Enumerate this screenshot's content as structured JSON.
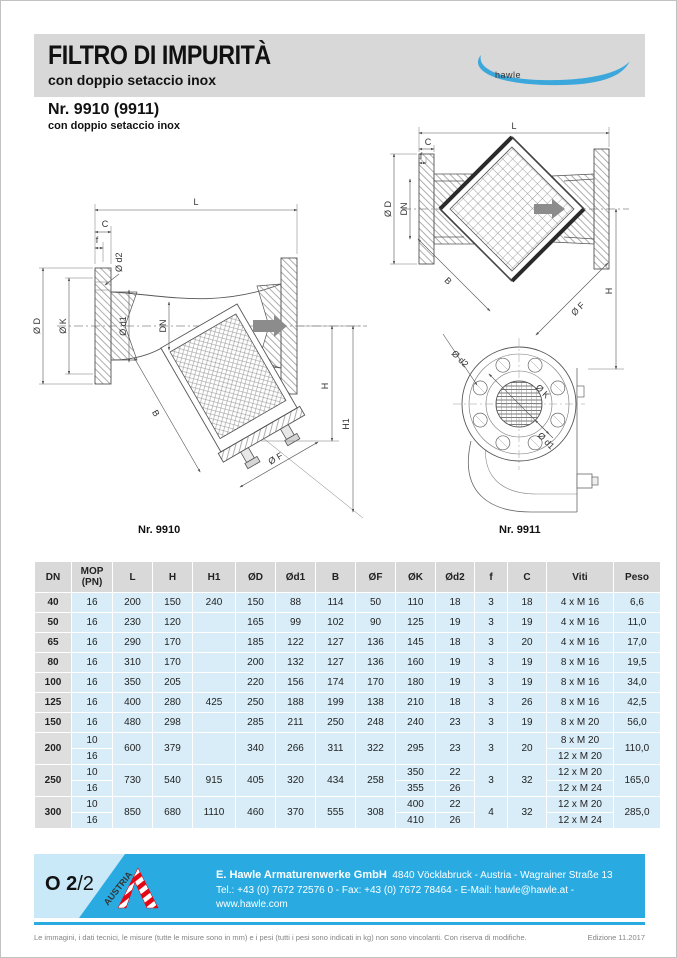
{
  "header": {
    "title": "FILTRO DI IMPURITÀ",
    "subtitle": "con doppio setaccio inox",
    "brand": "hawle"
  },
  "product": {
    "number": "Nr. 9910 (9911)",
    "variant": "con doppio setaccio inox"
  },
  "drawings": {
    "caption_9910": "Nr. 9910",
    "caption_9911": "Nr. 9911",
    "dim_labels": {
      "L": "L",
      "C": "C",
      "f": "f",
      "d2": "Ø d2",
      "D": "Ø D",
      "K": "Ø K",
      "d1": "Ø d1",
      "DN": "DN",
      "B": "B",
      "F": "Ø F",
      "H": "H",
      "H1": "H1"
    }
  },
  "table": {
    "headers": [
      "DN",
      "MOP (PN)",
      "L",
      "H",
      "H1",
      "ØD",
      "Ød1",
      "B",
      "ØF",
      "ØK",
      "Ød2",
      "f",
      "C",
      "Viti",
      "Peso"
    ],
    "rows": [
      {
        "dn": "40",
        "mop": [
          "16"
        ],
        "l": "200",
        "h": "150",
        "h1": "240",
        "D": "150",
        "d1": "88",
        "B": "114",
        "F": "50",
        "K": [
          "110"
        ],
        "d2": [
          "18"
        ],
        "f": "3",
        "c": "18",
        "viti": [
          "4 x M 16"
        ],
        "peso": "6,6"
      },
      {
        "dn": "50",
        "mop": [
          "16"
        ],
        "l": "230",
        "h": "120",
        "h1": "",
        "D": "165",
        "d1": "99",
        "B": "102",
        "F": "90",
        "K": [
          "125"
        ],
        "d2": [
          "19"
        ],
        "f": "3",
        "c": "19",
        "viti": [
          "4 x M 16"
        ],
        "peso": "11,0"
      },
      {
        "dn": "65",
        "mop": [
          "16"
        ],
        "l": "290",
        "h": "170",
        "h1": "",
        "D": "185",
        "d1": "122",
        "B": "127",
        "F": "136",
        "K": [
          "145"
        ],
        "d2": [
          "18"
        ],
        "f": "3",
        "c": "20",
        "viti": [
          "4 x M 16"
        ],
        "peso": "17,0"
      },
      {
        "dn": "80",
        "mop": [
          "16"
        ],
        "l": "310",
        "h": "170",
        "h1": "",
        "D": "200",
        "d1": "132",
        "B": "127",
        "F": "136",
        "K": [
          "160"
        ],
        "d2": [
          "19"
        ],
        "f": "3",
        "c": "19",
        "viti": [
          "8 x M 16"
        ],
        "peso": "19,5"
      },
      {
        "dn": "100",
        "mop": [
          "16"
        ],
        "l": "350",
        "h": "205",
        "h1": "",
        "D": "220",
        "d1": "156",
        "B": "174",
        "F": "170",
        "K": [
          "180"
        ],
        "d2": [
          "19"
        ],
        "f": "3",
        "c": "19",
        "viti": [
          "8 x M 16"
        ],
        "peso": "34,0"
      },
      {
        "dn": "125",
        "mop": [
          "16"
        ],
        "l": "400",
        "h": "280",
        "h1": "425",
        "D": "250",
        "d1": "188",
        "B": "199",
        "F": "138",
        "K": [
          "210"
        ],
        "d2": [
          "18"
        ],
        "f": "3",
        "c": "26",
        "viti": [
          "8 x M 16"
        ],
        "peso": "42,5"
      },
      {
        "dn": "150",
        "mop": [
          "16"
        ],
        "l": "480",
        "h": "298",
        "h1": "",
        "D": "285",
        "d1": "211",
        "B": "250",
        "F": "248",
        "K": [
          "240"
        ],
        "d2": [
          "23"
        ],
        "f": "3",
        "c": "19",
        "viti": [
          "8 x M 20"
        ],
        "peso": "56,0"
      },
      {
        "dn": "200",
        "mop": [
          "10",
          "16"
        ],
        "l": "600",
        "h": "379",
        "h1": "",
        "D": "340",
        "d1": "266",
        "B": "311",
        "F": "322",
        "K": [
          "295"
        ],
        "d2": [
          "23"
        ],
        "f": "3",
        "c": "20",
        "viti": [
          "8 x M 20",
          "12 x M 20"
        ],
        "peso": "110,0"
      },
      {
        "dn": "250",
        "mop": [
          "10",
          "16"
        ],
        "l": "730",
        "h": "540",
        "h1": "915",
        "D": "405",
        "d1": "320",
        "B": "434",
        "F": "258",
        "K": [
          "350",
          "355"
        ],
        "d2": [
          "22",
          "26"
        ],
        "f": "3",
        "c": "32",
        "viti": [
          "12 x M 20",
          "12 x M 24"
        ],
        "peso": "165,0"
      },
      {
        "dn": "300",
        "mop": [
          "10",
          "16"
        ],
        "l": "850",
        "h": "680",
        "h1": "1110",
        "D": "460",
        "d1": "370",
        "B": "555",
        "F": "308",
        "K": [
          "400",
          "410"
        ],
        "d2": [
          "22",
          "26"
        ],
        "f": "4",
        "c": "32",
        "viti": [
          "12 x M 20",
          "12 x M 24"
        ],
        "peso": "285,0"
      }
    ]
  },
  "footer": {
    "page_code_bold": "O 2",
    "page_code_rest": "/2",
    "austria_label": "AUSTRIA",
    "company_bold": "E. Hawle Armaturenwerke GmbH",
    "address": "4840 Vöcklabruck  -  Austria  -  Wagrainer Straße 13",
    "contact": "Tel.: +43 (0) 7672 72576 0  -  Fax: +43 (0) 7672 78464  -  E-Mail: hawle@hawle.at  -  www.hawle.com",
    "disclaimer": "Le immagini, i dati tecnici, le misure (tutte le misure sono in mm) e i pesi (tutti i pesi sono indicati in kg) non sono vincolanti. Con riserva di modifiche.",
    "edition": "Edizione 11.2017"
  },
  "colors": {
    "accent_cyan": "#29abe2",
    "swoosh_blue": "#3ba7db",
    "banner_gray": "#d8d8d8",
    "table_header_gray": "#d9d9d9",
    "table_cell_blue": "#d8edf8",
    "austria_red": "#e30613"
  }
}
